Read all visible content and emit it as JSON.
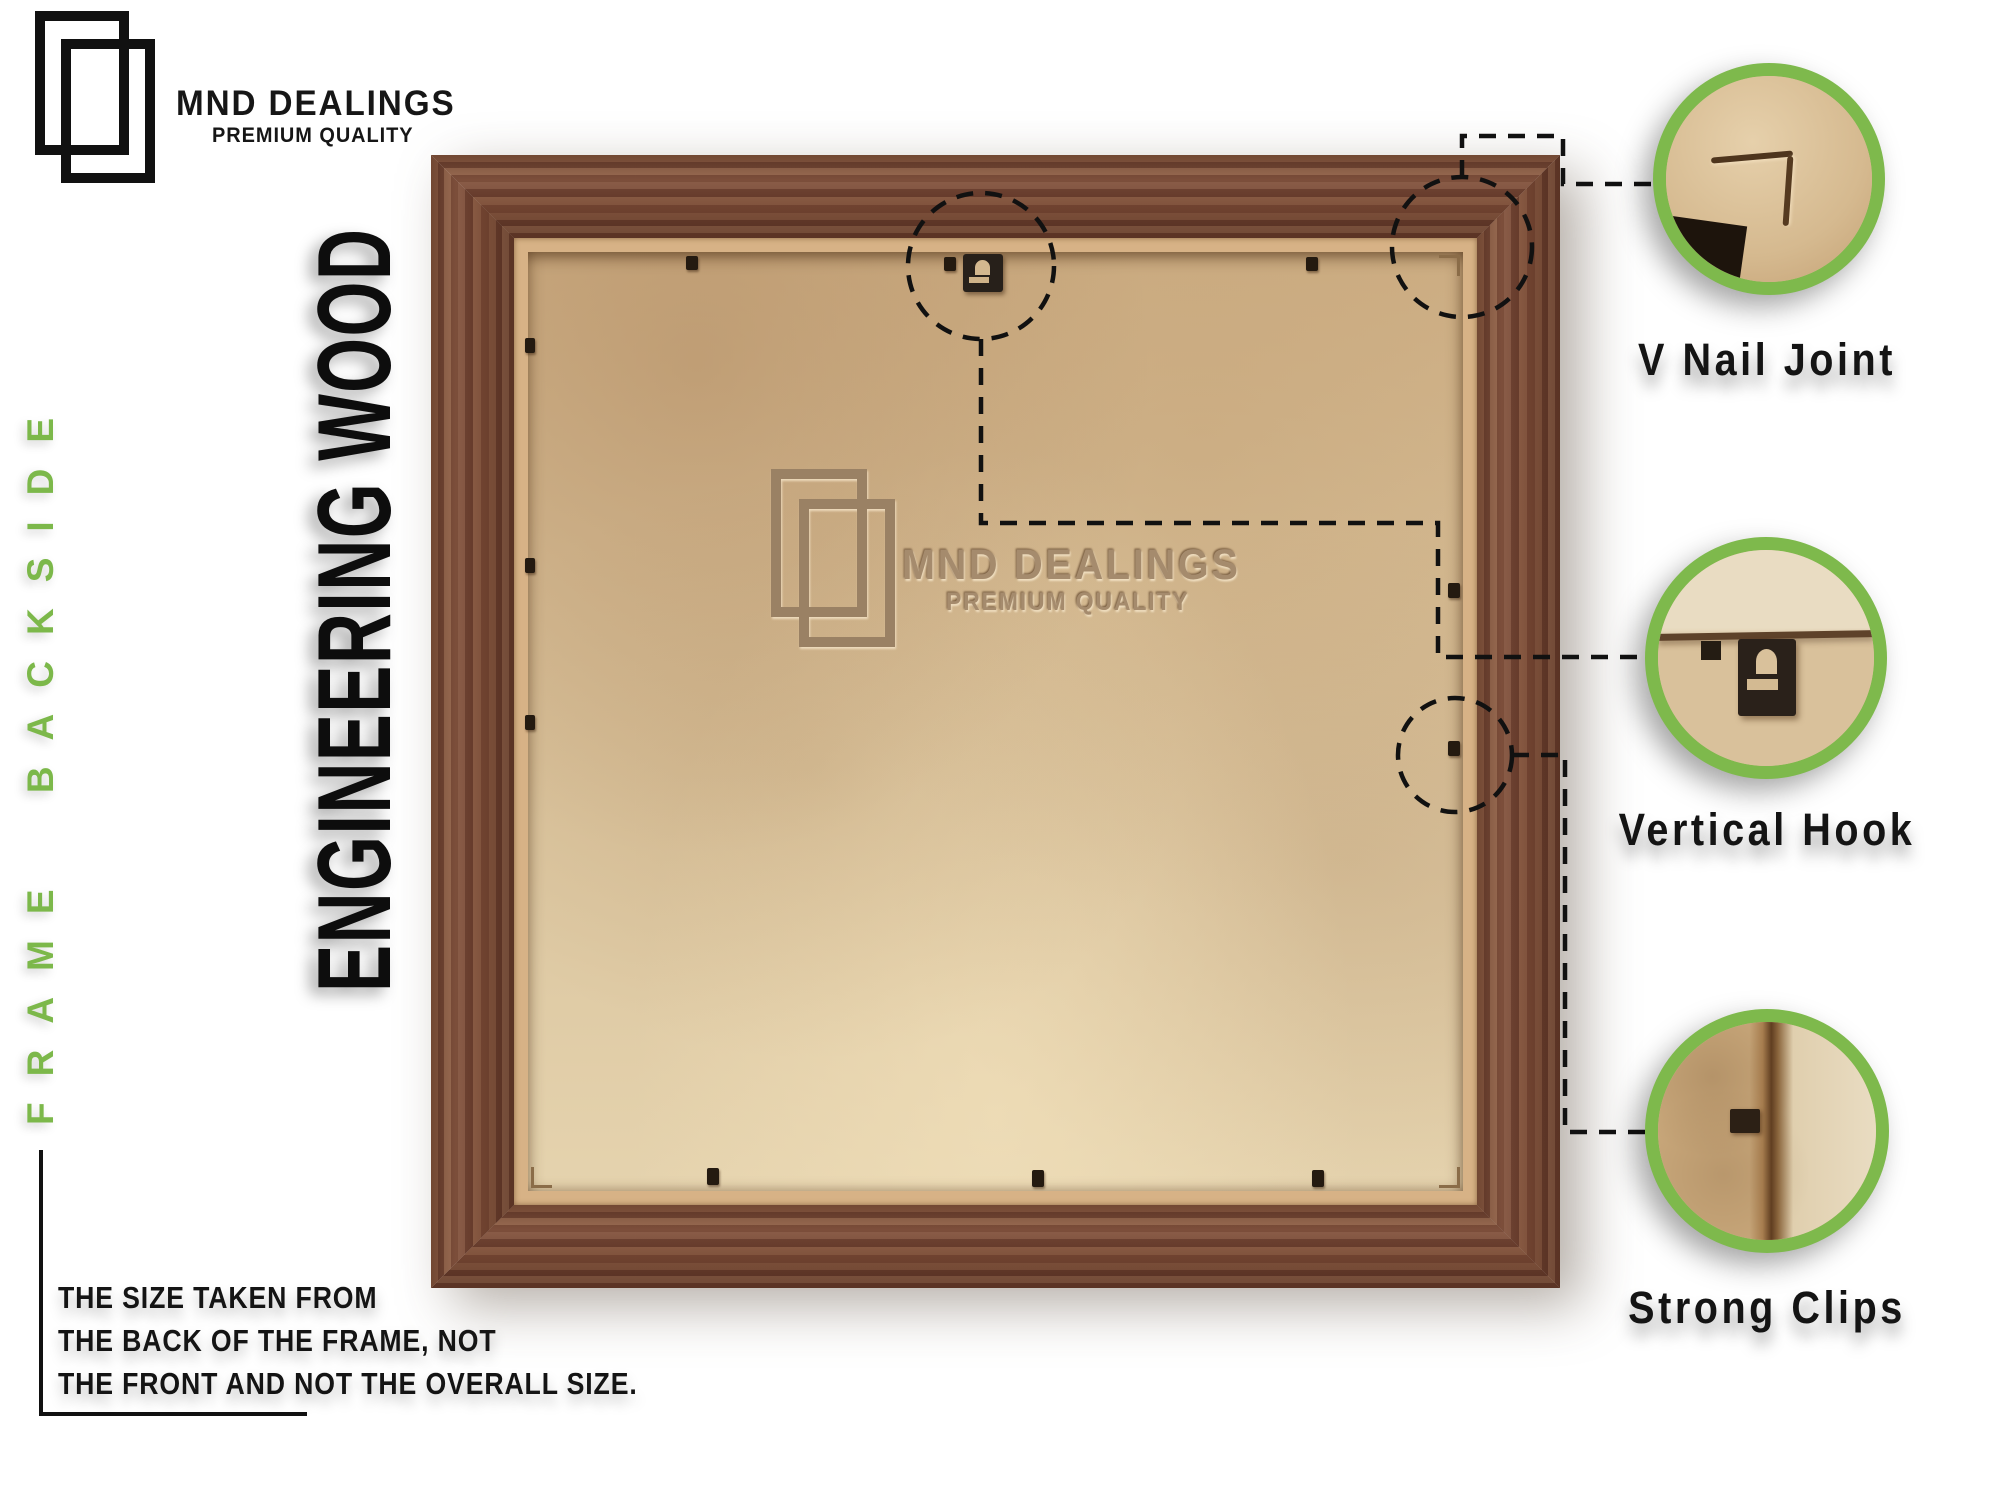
{
  "header": {
    "brand": "MND DEALINGS",
    "tagline": "PREMIUM QUALITY"
  },
  "side_label": "FRAME BACKSIDE",
  "title": "ENGINEERING WOOD",
  "watermark": {
    "brand": "MND DEALINGS",
    "tagline": "PREMIUM QUALITY"
  },
  "note": {
    "line1": "THE SIZE TAKEN FROM",
    "line2": "THE BACK OF THE FRAME, NOT",
    "line3": "THE FRONT AND NOT THE OVERALL SIZE."
  },
  "callouts": [
    {
      "label": "V Nail Joint"
    },
    {
      "label": "Vertical Hook"
    },
    {
      "label": "Strong Clips"
    }
  ],
  "colors": {
    "accent_green": "#7cb84a",
    "wood_brown": "#7d4f38",
    "backing_tan": "#d8c09a",
    "label_black": "#141414"
  }
}
